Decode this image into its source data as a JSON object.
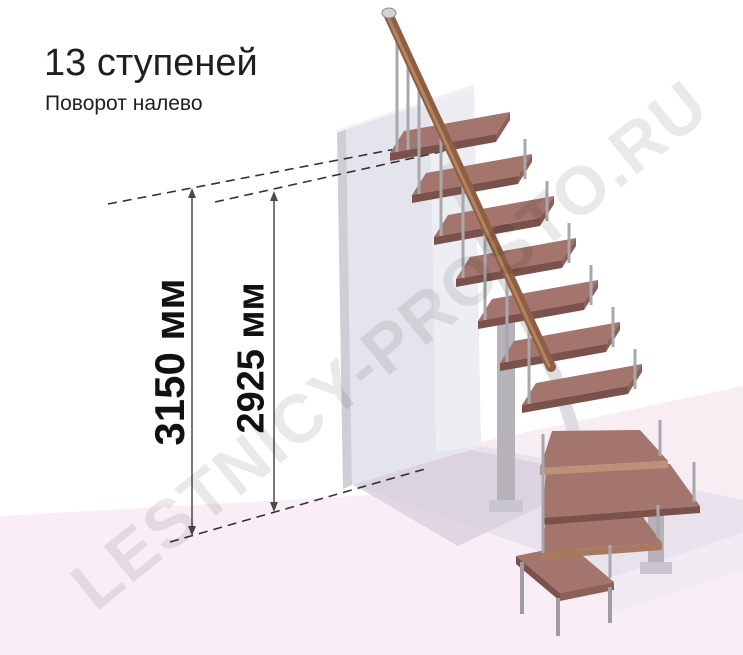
{
  "title": "13 ступеней",
  "subtitle": "Поворот налево",
  "watermark": "LESTNICY-PROSTO.RU",
  "diagram": {
    "steps_count": 13,
    "turn_direction": "налево",
    "dimension_total": "3150 мм",
    "dimension_upper": "2925 мм"
  },
  "colors": {
    "tread_top": "#a3756c",
    "tread_front": "#7b524b",
    "tread_side": "#8d6158",
    "winder1_front": "#bd9176",
    "winder3_front": "#a9795f",
    "handrail": "#8f5e44",
    "handrail_highlight": "#b08560",
    "rail_cap": "#d2d2d6",
    "baluster": "#a8a8ac",
    "leg": "#9d9da3",
    "wall_front": "#e4e5ec",
    "wall_side": "#cdced6",
    "wall_inner": "#edeef3",
    "wall_top_edge": "#f2f3f6",
    "floor_pink": "#f9eef5",
    "floor_pink_far": "#f8edf3",
    "slab_top": "#e8e2ed",
    "slab_front": "#f1ecf4",
    "shadow": "#d8d0dd",
    "column": "#b5b2ba",
    "column_base": "#c9c6cf",
    "spine": "#dcdce1",
    "dash_line": "#333333",
    "dimension_line": "#4a4a4a",
    "text": "#1f1f1f"
  }
}
